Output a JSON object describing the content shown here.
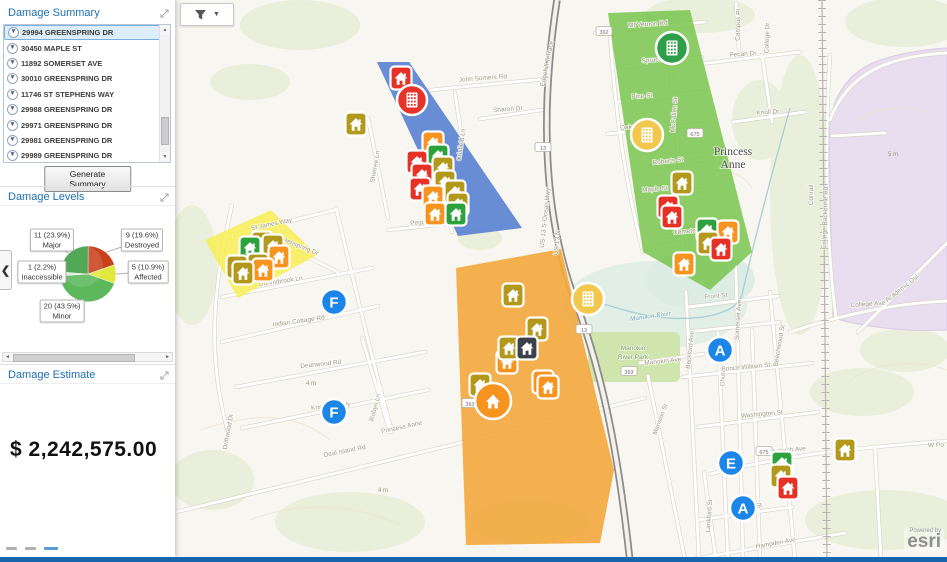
{
  "sidebar": {
    "summary": {
      "title": "Damage Summary",
      "addresses": [
        "29994 GREENSPRING DR",
        "30450 MAPLE ST",
        "11892 SOMERSET AVE",
        "30010 GREENSPRING DR",
        "11746 ST STEPHENS WAY",
        "29988 GREENSPRING DR",
        "29971 GREENSPRING DR",
        "29981 GREENSPRING DR",
        "29989 GREENSPRING DR"
      ],
      "selected_index": 0,
      "generate_button": "Generate Summary"
    },
    "levels": {
      "title": "Damage Levels"
    },
    "estimate": {
      "title": "Damage Estimate",
      "value": "$ 2,242,575.00"
    }
  },
  "chart_data": {
    "type": "pie",
    "title": "Damage Levels",
    "start_angle_deg": -90,
    "direction": "clockwise",
    "legend_position": "callouts",
    "slices": [
      {
        "label": "Destroyed",
        "count": 9,
        "pct": 19.6,
        "color": "#c8411c",
        "box": {
          "x": 142,
          "y": 32
        }
      },
      {
        "label": "Affected",
        "count": 5,
        "pct": 10.9,
        "color": "#e3e83e",
        "box": {
          "x": 148,
          "y": 64
        }
      },
      {
        "label": "Minor",
        "count": 20,
        "pct": 43.5,
        "color": "#5cb85a",
        "box": {
          "x": 62,
          "y": 103
        }
      },
      {
        "label": "Inaccessible",
        "count": 1,
        "pct": 2.2,
        "color": "#d8ecd0",
        "box": {
          "x": 42,
          "y": 64
        }
      },
      {
        "label": "Major",
        "count": 11,
        "pct": 23.9,
        "color": "#3c9c41",
        "box": {
          "x": 52,
          "y": 32
        }
      }
    ]
  },
  "map": {
    "town_label": "Princess Anne",
    "river_label": "Manokin River",
    "park_label_1": "Manokin",
    "park_label_2": "River Park",
    "railroad_label": "Conrail",
    "elevation_labels": [
      {
        "t": "5 m",
        "x": 888,
        "y": 156
      },
      {
        "t": "4 m",
        "x": 306,
        "y": 385
      },
      {
        "t": "4 m",
        "x": 378,
        "y": 492
      }
    ],
    "shields": [
      {
        "t": "362",
        "x": 604,
        "y": 32
      },
      {
        "t": "13",
        "x": 543,
        "y": 148
      },
      {
        "t": "13",
        "x": 584,
        "y": 330
      },
      {
        "t": "363",
        "x": 629,
        "y": 372
      },
      {
        "t": "675",
        "x": 695,
        "y": 134
      },
      {
        "t": "675",
        "x": 764,
        "y": 452
      },
      {
        "t": "363",
        "x": 470,
        "y": 404
      }
    ],
    "street_labels": [
      {
        "t": "John Somers Rd",
        "x": 483,
        "y": 80,
        "r": -4
      },
      {
        "t": "Sharon Dr",
        "x": 508,
        "y": 111,
        "r": -4
      },
      {
        "t": "Crisfield Ln",
        "x": 463,
        "y": 145,
        "r": -82
      },
      {
        "t": "Sherree Ln",
        "x": 377,
        "y": 167,
        "r": -80
      },
      {
        "t": "Peggs Ln",
        "x": 424,
        "y": 224,
        "r": -5
      },
      {
        "t": "Edgehill Terrace",
        "x": 549,
        "y": 64,
        "r": -78
      },
      {
        "t": "US-13 S-Ocean Hwy",
        "x": 547,
        "y": 218,
        "r": -84
      },
      {
        "t": "US-13 N",
        "x": 559,
        "y": 243,
        "r": -84
      },
      {
        "t": "Mt Vernon Rd",
        "x": 648,
        "y": 26,
        "r": -4
      },
      {
        "t": "Spruce",
        "x": 652,
        "y": 62,
        "r": -4
      },
      {
        "t": "Pine St",
        "x": 642,
        "y": 98,
        "r": -4
      },
      {
        "t": "Oak St",
        "x": 630,
        "y": 129,
        "r": -4
      },
      {
        "t": "Pecan Dr",
        "x": 743,
        "y": 56,
        "r": -4
      },
      {
        "t": "Knoll Dr",
        "x": 768,
        "y": 114,
        "r": -4
      },
      {
        "t": "Roberts St",
        "x": 668,
        "y": 163,
        "r": -6
      },
      {
        "t": "Maple St",
        "x": 655,
        "y": 191,
        "r": -4
      },
      {
        "t": "Cemetery L",
        "x": 690,
        "y": 233,
        "r": -5
      },
      {
        "t": "McCallen St",
        "x": 676,
        "y": 115,
        "r": -85
      },
      {
        "t": "Campus Pl",
        "x": 740,
        "y": 25,
        "r": -88
      },
      {
        "t": "College Dr",
        "x": 769,
        "y": 38,
        "r": -88
      },
      {
        "t": "College Backbone Rd",
        "x": 827,
        "y": 218,
        "r": -88
      },
      {
        "t": "College Ave",
        "x": 868,
        "y": 306,
        "r": -4
      },
      {
        "t": "Academic Ovl",
        "x": 903,
        "y": 290,
        "r": -38
      },
      {
        "t": "Somerset Ave",
        "x": 740,
        "y": 320,
        "r": -86
      },
      {
        "t": "Beckford Ave",
        "x": 692,
        "y": 350,
        "r": -84
      },
      {
        "t": "Church St",
        "x": 725,
        "y": 372,
        "r": -87
      },
      {
        "t": "Beechwood St",
        "x": 781,
        "y": 346,
        "r": -80
      },
      {
        "t": "Mansion St",
        "x": 662,
        "y": 420,
        "r": -70
      },
      {
        "t": "Lankford St",
        "x": 711,
        "y": 516,
        "r": -86
      },
      {
        "t": "Front St",
        "x": 716,
        "y": 298,
        "r": -5
      },
      {
        "t": "Prince William St",
        "x": 746,
        "y": 369,
        "r": -5
      },
      {
        "t": "Washington St",
        "x": 762,
        "y": 416,
        "r": -5
      },
      {
        "t": "Manokin Ave",
        "x": 663,
        "y": 363,
        "r": -6
      },
      {
        "t": "Antioch Ave",
        "x": 789,
        "y": 452,
        "r": -6
      },
      {
        "t": "W Po",
        "x": 936,
        "y": 447,
        "r": -2
      },
      {
        "t": "William St",
        "x": 748,
        "y": 509,
        "r": -8
      },
      {
        "t": "Hampden Ave",
        "x": 776,
        "y": 545,
        "r": -10
      },
      {
        "t": "St James Way",
        "x": 272,
        "y": 226,
        "r": -12
      },
      {
        "t": "Greenspring Dr",
        "x": 297,
        "y": 247,
        "r": 22
      },
      {
        "t": "Donnybrook Ln",
        "x": 281,
        "y": 283,
        "r": -8
      },
      {
        "t": "Indian Cottage Rd",
        "x": 299,
        "y": 323,
        "r": -8
      },
      {
        "t": "Deanwood Rd",
        "x": 321,
        "y": 366,
        "r": -6
      },
      {
        "t": "Kristwood Wy",
        "x": 331,
        "y": 408,
        "r": -6
      },
      {
        "t": "Robyn Ln",
        "x": 377,
        "y": 408,
        "r": -75
      },
      {
        "t": "Driftwood Dr",
        "x": 230,
        "y": 432,
        "r": -80
      },
      {
        "t": "Deal Island Rd",
        "x": 345,
        "y": 453,
        "r": -11
      },
      {
        "t": "Princess Anne",
        "x": 402,
        "y": 429,
        "r": -12
      },
      {
        "t": "Conrail",
        "x": 813,
        "y": 195,
        "r": -90
      }
    ],
    "zones": [
      {
        "name": "damage-zone-blue",
        "color": "#5b83d2",
        "opacity": 0.92,
        "points": "377,62 409,62 522,228 458,236"
      },
      {
        "name": "damage-zone-green",
        "color": "#79c64f",
        "opacity": 0.85,
        "points": "608,13 690,10 752,252 710,290 643,252"
      },
      {
        "name": "damage-zone-yellow",
        "color": "#f8ef4b",
        "opacity": 0.8,
        "points": "271,210 317,255 238,298 205,240"
      },
      {
        "name": "damage-zone-orange",
        "color": "#f3a93c",
        "opacity": 0.9,
        "points": "456,268 561,249 614,470 600,543 466,545"
      }
    ],
    "house_colors": {
      "destroyed": "#e53126",
      "major": "#f79420",
      "minor": "#2ca13c",
      "affected": "#b2991c",
      "inaccessible": "#3c4048"
    },
    "houses": [
      {
        "x": 401,
        "y": 78,
        "level": "destroyed"
      },
      {
        "x": 356,
        "y": 124,
        "level": "affected"
      },
      {
        "x": 433,
        "y": 143,
        "level": "major"
      },
      {
        "x": 438,
        "y": 156,
        "level": "minor"
      },
      {
        "x": 417,
        "y": 162,
        "level": "destroyed"
      },
      {
        "x": 443,
        "y": 168,
        "level": "affected"
      },
      {
        "x": 422,
        "y": 175,
        "level": "destroyed"
      },
      {
        "x": 445,
        "y": 182,
        "level": "affected"
      },
      {
        "x": 420,
        "y": 189,
        "level": "destroyed"
      },
      {
        "x": 455,
        "y": 192,
        "level": "affected"
      },
      {
        "x": 433,
        "y": 197,
        "level": "major"
      },
      {
        "x": 458,
        "y": 204,
        "level": "affected"
      },
      {
        "x": 435,
        "y": 214,
        "level": "major"
      },
      {
        "x": 456,
        "y": 214,
        "level": "minor"
      },
      {
        "x": 262,
        "y": 243,
        "level": "affected"
      },
      {
        "x": 273,
        "y": 246,
        "level": "affected"
      },
      {
        "x": 250,
        "y": 248,
        "level": "minor"
      },
      {
        "x": 279,
        "y": 257,
        "level": "major"
      },
      {
        "x": 258,
        "y": 265,
        "level": "affected"
      },
      {
        "x": 237,
        "y": 267,
        "level": "affected"
      },
      {
        "x": 263,
        "y": 270,
        "level": "major"
      },
      {
        "x": 243,
        "y": 273,
        "level": "affected"
      },
      {
        "x": 682,
        "y": 183,
        "level": "affected"
      },
      {
        "x": 668,
        "y": 207,
        "level": "destroyed"
      },
      {
        "x": 672,
        "y": 217,
        "level": "destroyed"
      },
      {
        "x": 707,
        "y": 230,
        "level": "minor"
      },
      {
        "x": 728,
        "y": 232,
        "level": "major"
      },
      {
        "x": 708,
        "y": 243,
        "level": "affected"
      },
      {
        "x": 721,
        "y": 249,
        "level": "destroyed"
      },
      {
        "x": 684,
        "y": 264,
        "level": "major"
      },
      {
        "x": 513,
        "y": 295,
        "level": "affected"
      },
      {
        "x": 537,
        "y": 329,
        "level": "affected"
      },
      {
        "x": 507,
        "y": 362,
        "level": "major"
      },
      {
        "x": 509,
        "y": 348,
        "level": "affected"
      },
      {
        "x": 527,
        "y": 348,
        "level": "inaccessible"
      },
      {
        "x": 480,
        "y": 385,
        "level": "affected"
      },
      {
        "x": 543,
        "y": 382,
        "level": "major"
      },
      {
        "x": 548,
        "y": 387,
        "level": "major"
      },
      {
        "x": 845,
        "y": 450,
        "level": "affected"
      },
      {
        "x": 782,
        "y": 463,
        "level": "minor"
      },
      {
        "x": 781,
        "y": 476,
        "level": "affected"
      },
      {
        "x": 788,
        "y": 488,
        "level": "destroyed"
      }
    ],
    "clusters": [
      {
        "x": 412,
        "y": 100,
        "r": 15,
        "color": "#e8332a",
        "glyph": "building"
      },
      {
        "x": 672,
        "y": 48,
        "r": 16,
        "color": "#2f9e49",
        "glyph": "building"
      },
      {
        "x": 647,
        "y": 135,
        "r": 16,
        "color": "#f2c74e",
        "glyph": "building"
      },
      {
        "x": 588,
        "y": 299,
        "r": 16,
        "color": "#f2c74e",
        "glyph": "building"
      },
      {
        "x": 493,
        "y": 401,
        "r": 18,
        "color": "#f79420",
        "glyph": "house"
      }
    ],
    "letters": [
      {
        "t": "F",
        "x": 334,
        "y": 302
      },
      {
        "t": "F",
        "x": 334,
        "y": 412
      },
      {
        "t": "A",
        "x": 720,
        "y": 350
      },
      {
        "t": "E",
        "x": 731,
        "y": 463
      },
      {
        "t": "A",
        "x": 743,
        "y": 508
      }
    ],
    "letter_color": "#1b85e8"
  },
  "attribution": {
    "powered_by": "Powered by",
    "brand": "esri"
  }
}
